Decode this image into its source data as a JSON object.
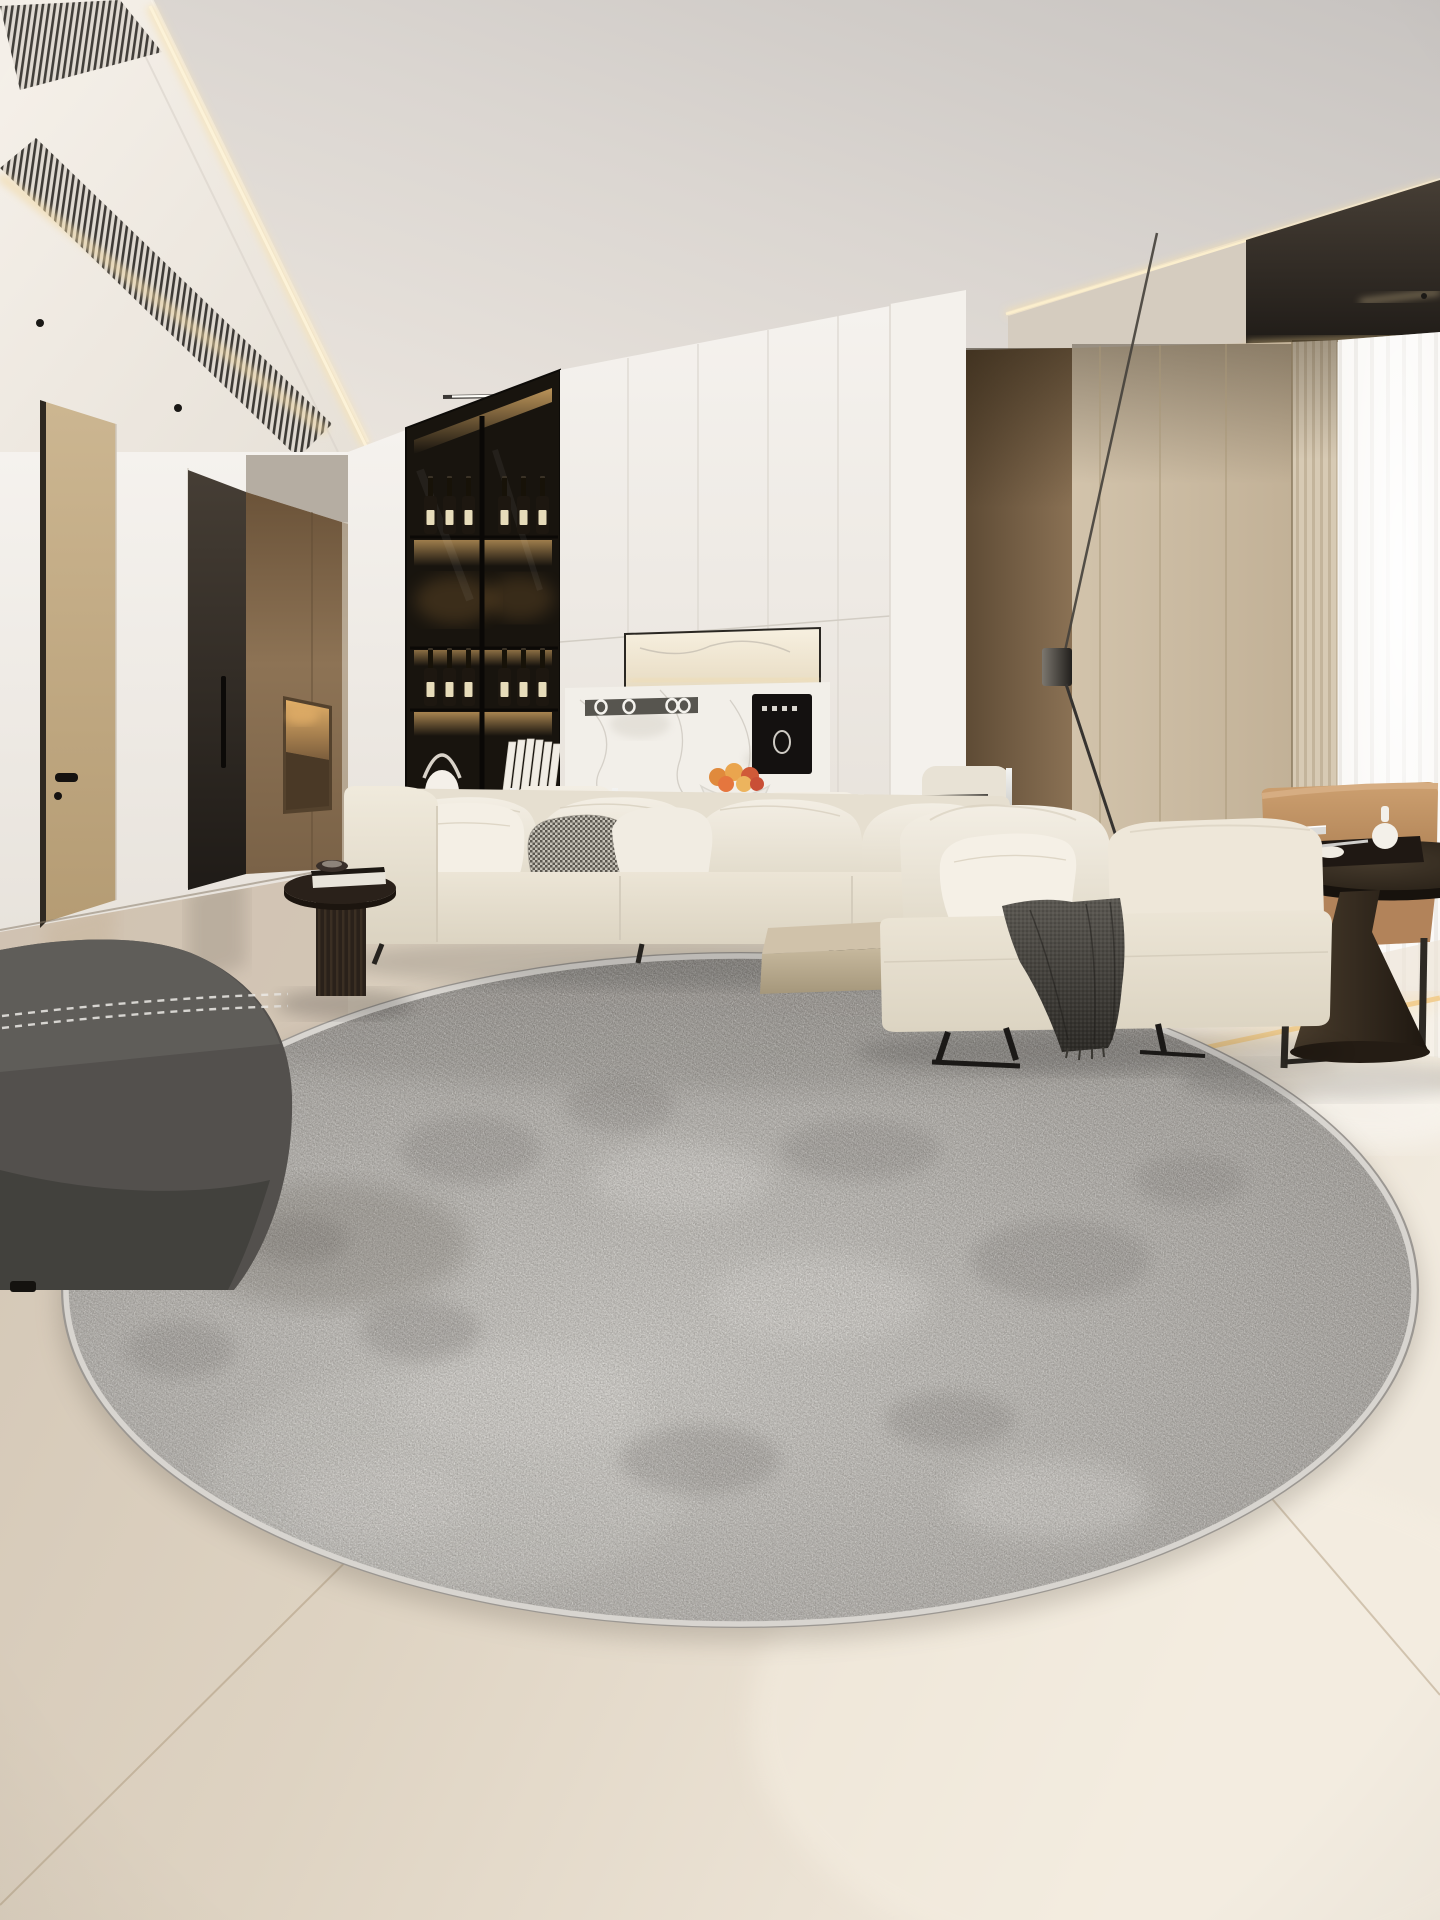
{
  "meta": {
    "description": "Photorealistic render of a minimalist beige living room featuring a large round distressed gray rug on glossy cream tile",
    "image_type": "interior-photo"
  },
  "palette": {
    "ceiling": "#e6e1dc",
    "cove_light": "#f2dcab",
    "white_wall": "#f3f0ec",
    "wood_door": "#c3ac85",
    "dark_door": "#352f29",
    "tan_panel": "#84694b",
    "cabinet_dark": "#18140e",
    "shelf_glow": "#dfae67",
    "white_cabinet": "#efece7",
    "marble": "#f2efe9",
    "brown_wall": "#77624a",
    "beige_panel": "#cdbea6",
    "curtain": "#f9f7f4",
    "sofa_cream": "#eee8da",
    "throw_dark": "#43403c",
    "leather_tan": "#bd9166",
    "floor_beige": "#dbcfbe",
    "rug_gray": "#a7a49f",
    "rug_border": "#d8d5d0",
    "ottoman_gray": "#53504d",
    "step_light": "#f2cd8e"
  },
  "scene": {
    "ceiling": {
      "center_spotlights": 4,
      "track_light_segments": 5,
      "louver_vents": 2
    },
    "wine_cabinet": {
      "rows": [
        {
          "y": 478,
          "xs": [
            424,
            443,
            462,
            498,
            517,
            536
          ]
        },
        {
          "y": 650,
          "xs": [
            424,
            443,
            462,
            498,
            517,
            536
          ]
        }
      ],
      "shelves": 4
    },
    "dining": {
      "chairs_visible": 3,
      "fruit_count": 6
    },
    "objects": [
      "recessed-ceiling-with-cove-lighting",
      "linear-track-light",
      "louvered-ac-vents",
      "wood-entry-door",
      "dark-interior-door",
      "tan-panel-niche-with-light",
      "backlit-wine-display-cabinet",
      "lantern-table-lamp",
      "white-books",
      "white-upper-cabinets",
      "marble-niche-with-light",
      "marble-backsplash",
      "utensil-rail-with-rings",
      "black-water-dispenser",
      "fruit-bowl",
      "cream-dining-chairs",
      "dark-dining-table",
      "cream-modular-sofa",
      "patterned-accent-pillow",
      "wood-side-platform",
      "cream-chaise-daybed",
      "dark-gray-knit-throw",
      "black-floor-lamp",
      "tan-leather-armchair",
      "dark-pedestal-side-table",
      "white-bud-vase",
      "recessed-step-light-strip",
      "sheer-pleated-curtain",
      "fluted-wood-panel",
      "round-distressed-gray-rug",
      "charcoal-fabric-ottoman",
      "black-fluted-side-table",
      "book-on-table",
      "cream-tile-floor"
    ]
  }
}
